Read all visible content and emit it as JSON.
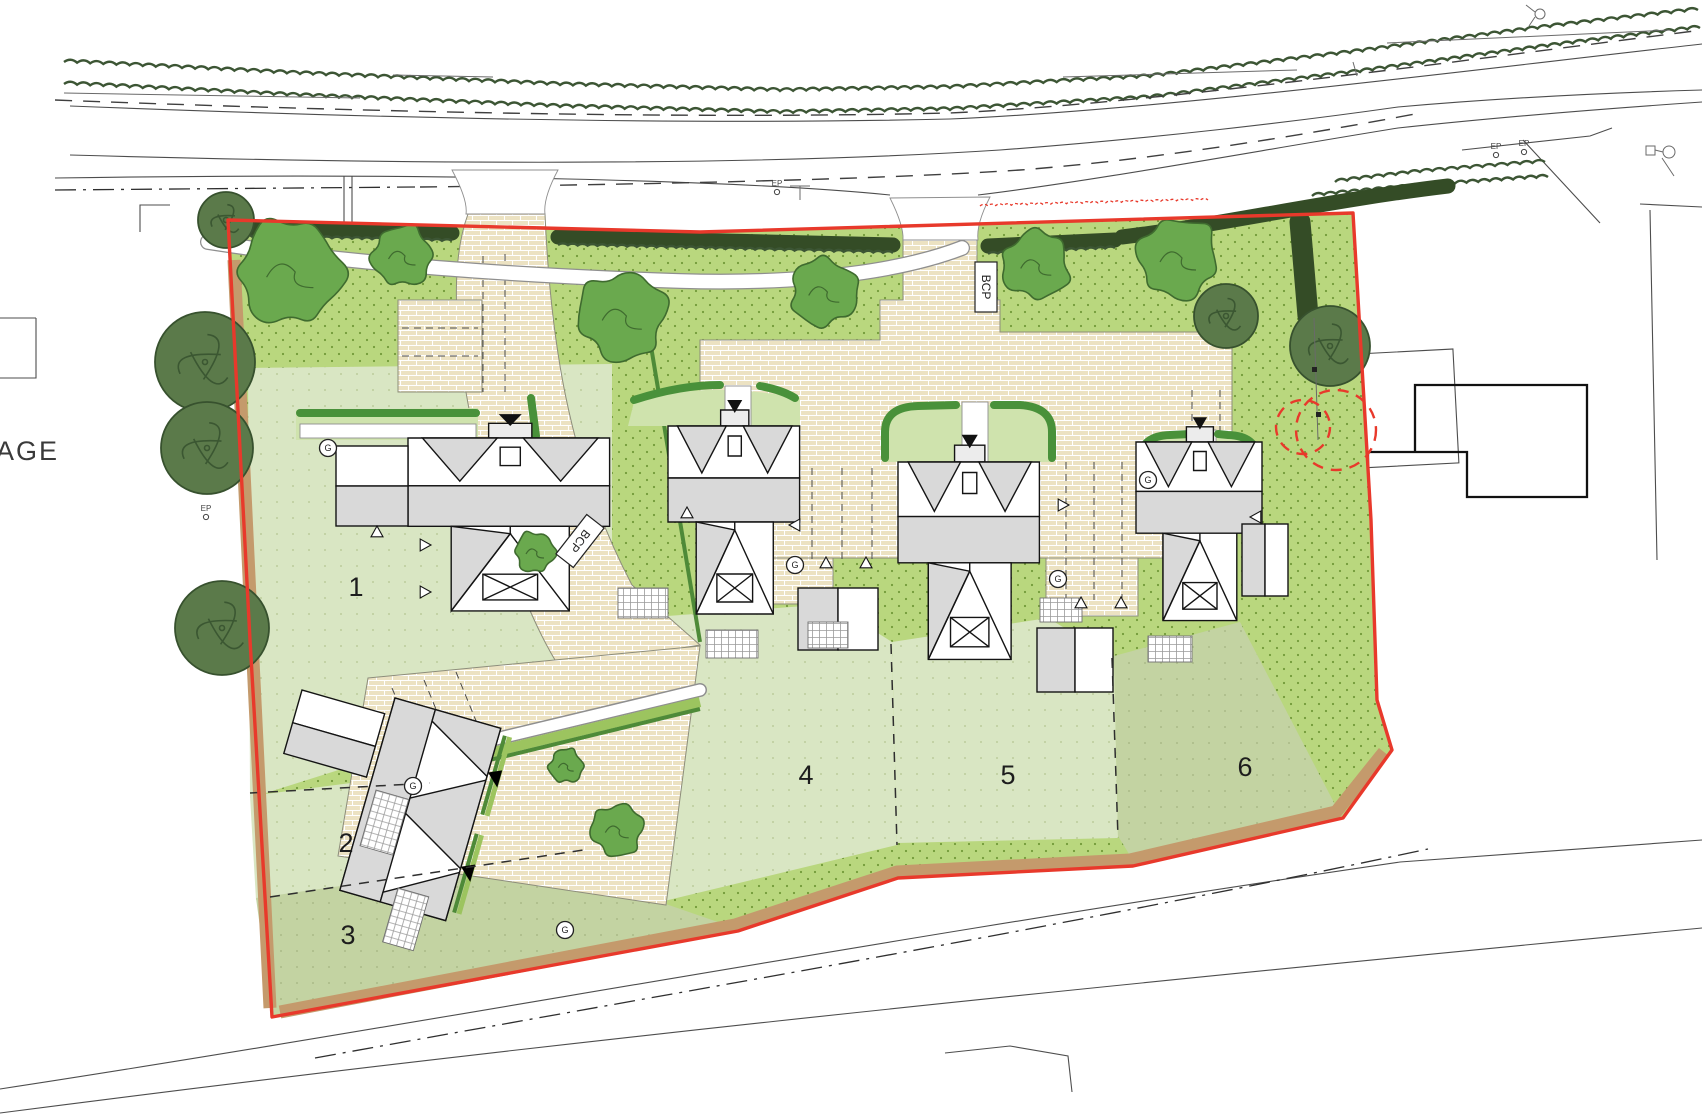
{
  "labels": {
    "neighbor_partial": "AGE",
    "bcp": "BCP",
    "ep": "EP",
    "gully": "G",
    "plots": [
      "1",
      "2",
      "3",
      "4",
      "5",
      "6"
    ]
  },
  "colors": {
    "boundary_red": "#e8392b",
    "lawn_bright": "#b9d77e",
    "lawn_pale": "#d9e6c3",
    "lawn_sage": "#c3d3a2",
    "garden_front": "#cfe3ad",
    "paving": "#ece2c2",
    "hedge_dark": "#344c26",
    "hedge_mid": "#49913a",
    "verge_bright": "#9cc45f",
    "shrub_green": "#6aa94e",
    "tree_green": "#5b7a4a",
    "roof_grey": "#d9d9d9",
    "hedgerow_tan": "#c49a6c"
  }
}
